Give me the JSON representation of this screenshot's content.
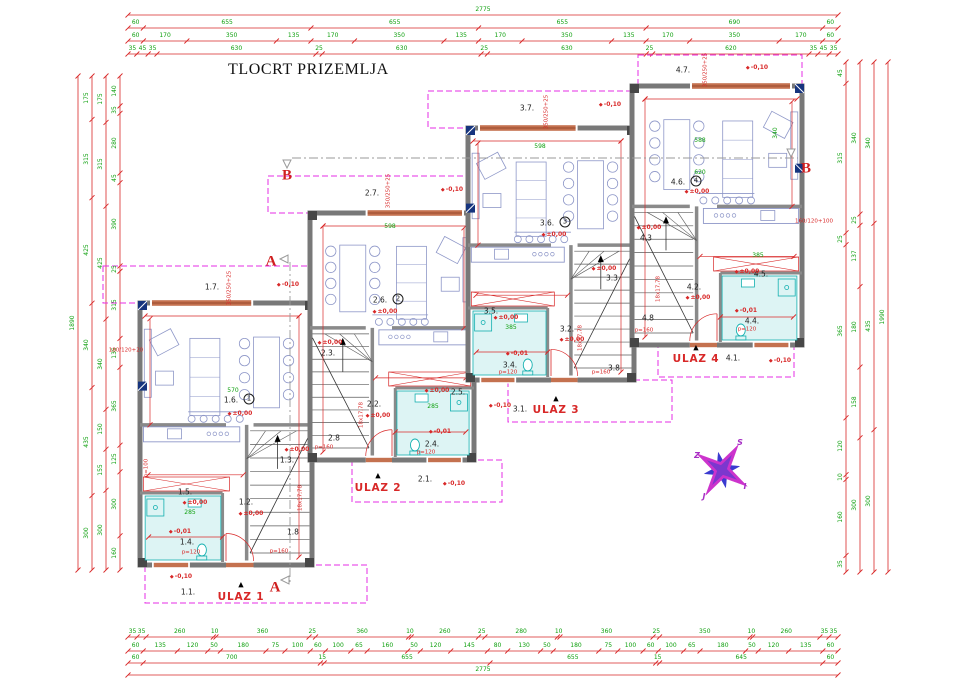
{
  "title": "TLOCRT PRIZEMLJA",
  "colors": {
    "dim_red": "#d82828",
    "dim_green": "#0fa00f",
    "wall_gray": "#787878",
    "dash_magenta": "#e52ee5",
    "furniture_blue": "#8e97c8",
    "fixture_cyan": "#14b0b0",
    "bath_fill": "#ddf4f4",
    "window_navy": "#16347e",
    "door_orange": "#c4714f",
    "compass_magenta": "#cc33cc",
    "compass_blue": "#3a3ad0"
  },
  "sections": [
    {
      "t": "B",
      "x": 287,
      "y": 176,
      "k": "section"
    },
    {
      "t": "B",
      "x": 806,
      "y": 169,
      "k": "section"
    },
    {
      "t": "A",
      "x": 271,
      "y": 262,
      "k": "section"
    },
    {
      "t": "A",
      "x": 275,
      "y": 588,
      "k": "section"
    }
  ],
  "compass_letters": [
    {
      "t": "S",
      "x": 740,
      "y": 443,
      "k": "comp"
    },
    {
      "t": "Z",
      "x": 697,
      "y": 456,
      "k": "comp"
    },
    {
      "t": "I",
      "x": 745,
      "y": 487,
      "k": "comp"
    },
    {
      "t": "J",
      "x": 704,
      "y": 497,
      "k": "comp"
    }
  ],
  "dims": {
    "top": {
      "x0": 128,
      "x1": 838,
      "rows": [
        {
          "y": 15,
          "values": [
            "2775"
          ]
        },
        {
          "y": 28,
          "values": [
            "60",
            "655",
            "655",
            "655",
            "690",
            "60"
          ]
        },
        {
          "y": 41,
          "values": [
            "60",
            "170",
            "350",
            "135",
            "170",
            "350",
            "135",
            "170",
            "350",
            "135",
            "170",
            "350",
            "170",
            "60"
          ]
        },
        {
          "y": 54,
          "values": [
            "35",
            "45",
            "35",
            "630",
            "25",
            "630",
            "25",
            "630",
            "25",
            "620",
            "35",
            "45",
            "35"
          ]
        }
      ]
    },
    "bottom": {
      "x0": 128,
      "x1": 838,
      "rows": [
        {
          "y": 637,
          "values": [
            "35",
            "35",
            "260",
            "10",
            "360",
            "25",
            "360",
            "10",
            "260",
            "25",
            "280",
            "10",
            "360",
            "25",
            "350",
            "10",
            "260",
            "35",
            "35"
          ]
        },
        {
          "y": 651,
          "values": [
            "60",
            "135",
            "120",
            "50",
            "180",
            "75",
            "100",
            "60",
            "100",
            "65",
            "160",
            "50",
            "120",
            "145",
            "80",
            "130",
            "50",
            "180",
            "75",
            "100",
            "60",
            "100",
            "65",
            "180",
            "50",
            "120",
            "135",
            "60"
          ]
        },
        {
          "y": 663,
          "values": [
            "60",
            "700",
            "15",
            "655",
            "655",
            "15",
            "645",
            "60"
          ]
        },
        {
          "y": 675,
          "values": [
            "2775"
          ]
        }
      ]
    },
    "left": {
      "y0": 76,
      "y1": 570,
      "cols": [
        {
          "x": 78,
          "values": [
            "1890"
          ]
        },
        {
          "x": 92,
          "values": [
            "175",
            "315",
            "425",
            "340",
            "435",
            "300"
          ]
        },
        {
          "x": 106,
          "values": [
            "175",
            "315",
            "425",
            "340",
            "150",
            "155",
            "300"
          ]
        },
        {
          "x": 120,
          "values": [
            "140",
            "35",
            "280",
            "45",
            "390",
            "25",
            "315",
            "135",
            "365",
            "125",
            "300",
            "160"
          ]
        }
      ]
    },
    "right": {
      "y0": 62,
      "y1": 572,
      "cols": [
        {
          "x": 846,
          "values": [
            "45",
            "315",
            "25",
            "365",
            "120",
            "10",
            "160",
            "35"
          ]
        },
        {
          "x": 860,
          "values": [
            "340",
            "25",
            "137",
            "180",
            "158",
            "300"
          ]
        },
        {
          "x": 874,
          "values": [
            "340",
            "435",
            "300"
          ]
        },
        {
          "x": 888,
          "values": [
            "1990"
          ]
        }
      ]
    }
  },
  "units": [
    {
      "id": 1,
      "entrance": "ULAZ 1",
      "labels": [
        {
          "t": "1.7.",
          "x": 212,
          "y": 287,
          "k": "room"
        },
        {
          "t": "-0,10",
          "x": 288,
          "y": 285,
          "k": "level"
        },
        {
          "t": "350/250+25",
          "x": 230,
          "y": 288,
          "k": "red",
          "r": -90
        },
        {
          "t": "570",
          "x": 233,
          "y": 391,
          "k": "green"
        },
        {
          "t": "1.6.",
          "x": 231,
          "y": 400,
          "k": "room"
        },
        {
          "t": "1",
          "x": 249,
          "y": 399,
          "k": "circ"
        },
        {
          "t": "±0,00",
          "x": 240,
          "y": 414,
          "k": "level"
        },
        {
          "t": "1.5.",
          "x": 185,
          "y": 492,
          "k": "room"
        },
        {
          "t": "±0,00",
          "x": 195,
          "y": 503,
          "k": "level"
        },
        {
          "t": "285",
          "x": 190,
          "y": 513,
          "k": "green"
        },
        {
          "t": "1.2.",
          "x": 246,
          "y": 502,
          "k": "room"
        },
        {
          "t": "±0,00",
          "x": 251,
          "y": 514,
          "k": "level"
        },
        {
          "t": "1.3.",
          "x": 287,
          "y": 460,
          "k": "room"
        },
        {
          "t": "±0,00",
          "x": 297,
          "y": 450,
          "k": "level"
        },
        {
          "t": "1.4.",
          "x": 187,
          "y": 542,
          "k": "room"
        },
        {
          "t": "-0,01",
          "x": 180,
          "y": 532,
          "k": "level"
        },
        {
          "t": "p=120",
          "x": 191,
          "y": 553,
          "k": "red"
        },
        {
          "t": "1.8",
          "x": 293,
          "y": 532,
          "k": "room"
        },
        {
          "t": "p=160",
          "x": 279,
          "y": 552,
          "k": "red"
        },
        {
          "t": "18x17,78",
          "x": 301,
          "y": 498,
          "k": "red",
          "r": -90
        },
        {
          "t": "180/120+20",
          "x": 126,
          "y": 351,
          "k": "red"
        },
        {
          "t": "1.1.",
          "x": 188,
          "y": 592,
          "k": "room"
        },
        {
          "t": "-0,10",
          "x": 181,
          "y": 577,
          "k": "level"
        },
        {
          "t": "▲",
          "x": 241,
          "y": 585,
          "k": "tri"
        },
        {
          "t": "ULAZ 1",
          "x": 241,
          "y": 597,
          "k": "ulaz"
        }
      ]
    },
    {
      "id": 2,
      "entrance": "ULAZ 2",
      "labels": [
        {
          "t": "2.7.",
          "x": 372,
          "y": 193,
          "k": "room"
        },
        {
          "t": "-0,10",
          "x": 452,
          "y": 190,
          "k": "level"
        },
        {
          "t": "350/250+25",
          "x": 389,
          "y": 191,
          "k": "red",
          "r": -90
        },
        {
          "t": "598",
          "x": 390,
          "y": 227,
          "k": "green"
        },
        {
          "t": "2.6.",
          "x": 380,
          "y": 300,
          "k": "room"
        },
        {
          "t": "2",
          "x": 398,
          "y": 299,
          "k": "circ"
        },
        {
          "t": "±0,00",
          "x": 385,
          "y": 312,
          "k": "level"
        },
        {
          "t": "2.3.",
          "x": 328,
          "y": 353,
          "k": "room"
        },
        {
          "t": "±0,00",
          "x": 330,
          "y": 343,
          "k": "level"
        },
        {
          "t": "2.2.",
          "x": 374,
          "y": 404,
          "k": "room"
        },
        {
          "t": "±0,00",
          "x": 378,
          "y": 416,
          "k": "level"
        },
        {
          "t": "2.5.",
          "x": 458,
          "y": 392,
          "k": "room"
        },
        {
          "t": "±0,00",
          "x": 437,
          "y": 391,
          "k": "level"
        },
        {
          "t": "285",
          "x": 433,
          "y": 407,
          "k": "green"
        },
        {
          "t": "2.4.",
          "x": 432,
          "y": 444,
          "k": "room"
        },
        {
          "t": "-0,01",
          "x": 440,
          "y": 432,
          "k": "level"
        },
        {
          "t": "p=120",
          "x": 426,
          "y": 453,
          "k": "red"
        },
        {
          "t": "2.8",
          "x": 334,
          "y": 438,
          "k": "room"
        },
        {
          "t": "p=160",
          "x": 324,
          "y": 448,
          "k": "red"
        },
        {
          "t": "18x17,78",
          "x": 362,
          "y": 415,
          "k": "red",
          "r": -90
        },
        {
          "t": "2.1.",
          "x": 425,
          "y": 479,
          "k": "room"
        },
        {
          "t": "-0,10",
          "x": 454,
          "y": 484,
          "k": "level"
        },
        {
          "t": "▲",
          "x": 378,
          "y": 476,
          "k": "tri"
        },
        {
          "t": "ULAZ 2",
          "x": 378,
          "y": 488,
          "k": "ulaz"
        }
      ]
    },
    {
      "id": 3,
      "entrance": "ULAZ 3",
      "labels": [
        {
          "t": "3.7.",
          "x": 527,
          "y": 108,
          "k": "room"
        },
        {
          "t": "-0,10",
          "x": 610,
          "y": 105,
          "k": "level"
        },
        {
          "t": "350/250+25",
          "x": 547,
          "y": 112,
          "k": "red",
          "r": -90
        },
        {
          "t": "598",
          "x": 540,
          "y": 147,
          "k": "green"
        },
        {
          "t": "3.6.",
          "x": 547,
          "y": 223,
          "k": "room"
        },
        {
          "t": "3",
          "x": 565,
          "y": 222,
          "k": "circ"
        },
        {
          "t": "±0,00",
          "x": 554,
          "y": 235,
          "k": "level"
        },
        {
          "t": "3.5.",
          "x": 491,
          "y": 311,
          "k": "room"
        },
        {
          "t": "±0,00",
          "x": 506,
          "y": 318,
          "k": "level"
        },
        {
          "t": "385",
          "x": 511,
          "y": 328,
          "k": "green"
        },
        {
          "t": "3.3",
          "x": 612,
          "y": 278,
          "k": "room"
        },
        {
          "t": "±0,00",
          "x": 604,
          "y": 269,
          "k": "level"
        },
        {
          "t": "3.2.",
          "x": 567,
          "y": 329,
          "k": "room"
        },
        {
          "t": "±0,00",
          "x": 572,
          "y": 340,
          "k": "level"
        },
        {
          "t": "3.4.",
          "x": 510,
          "y": 365,
          "k": "room"
        },
        {
          "t": "-0,01",
          "x": 517,
          "y": 354,
          "k": "level"
        },
        {
          "t": "p=120",
          "x": 508,
          "y": 373,
          "k": "red"
        },
        {
          "t": "3.8",
          "x": 614,
          "y": 368,
          "k": "room"
        },
        {
          "t": "p=160",
          "x": 601,
          "y": 373,
          "k": "red"
        },
        {
          "t": "18x17,78",
          "x": 581,
          "y": 338,
          "k": "red",
          "r": -90
        },
        {
          "t": "3.1.",
          "x": 520,
          "y": 409,
          "k": "room"
        },
        {
          "t": "-0,10",
          "x": 500,
          "y": 406,
          "k": "level"
        },
        {
          "t": "▲",
          "x": 556,
          "y": 399,
          "k": "tri"
        },
        {
          "t": "ULAZ 3",
          "x": 556,
          "y": 410,
          "k": "ulaz"
        }
      ]
    },
    {
      "id": 4,
      "entrance": "ULAZ 4",
      "labels": [
        {
          "t": "4.7.",
          "x": 683,
          "y": 70,
          "k": "room"
        },
        {
          "t": "-0,10",
          "x": 757,
          "y": 68,
          "k": "level"
        },
        {
          "t": "350/250+25",
          "x": 706,
          "y": 70,
          "k": "red",
          "r": -90
        },
        {
          "t": "588",
          "x": 700,
          "y": 141,
          "k": "green"
        },
        {
          "t": "4.6.",
          "x": 678,
          "y": 182,
          "k": "room"
        },
        {
          "t": "4",
          "x": 696,
          "y": 181,
          "k": "circ"
        },
        {
          "t": "±0,00",
          "x": 697,
          "y": 192,
          "k": "level"
        },
        {
          "t": "620",
          "x": 700,
          "y": 173,
          "k": "green"
        },
        {
          "t": "340",
          "x": 776,
          "y": 133,
          "k": "green",
          "r": -90
        },
        {
          "t": "4.3",
          "x": 646,
          "y": 238,
          "k": "room"
        },
        {
          "t": "±0,00",
          "x": 649,
          "y": 228,
          "k": "level"
        },
        {
          "t": "4.2.",
          "x": 694,
          "y": 287,
          "k": "room"
        },
        {
          "t": "±0,00",
          "x": 698,
          "y": 298,
          "k": "level"
        },
        {
          "t": "4.5.",
          "x": 761,
          "y": 274,
          "k": "room"
        },
        {
          "t": "±0,00",
          "x": 747,
          "y": 272,
          "k": "level"
        },
        {
          "t": "385",
          "x": 758,
          "y": 256,
          "k": "green"
        },
        {
          "t": "4.4.",
          "x": 752,
          "y": 321,
          "k": "room"
        },
        {
          "t": "-0,01",
          "x": 746,
          "y": 311,
          "k": "level"
        },
        {
          "t": "p=120",
          "x": 747,
          "y": 330,
          "k": "red"
        },
        {
          "t": "4.8",
          "x": 648,
          "y": 318,
          "k": "room"
        },
        {
          "t": "p=160",
          "x": 644,
          "y": 331,
          "k": "red"
        },
        {
          "t": "18x17,78",
          "x": 659,
          "y": 289,
          "k": "red",
          "r": -90
        },
        {
          "t": "4.1.",
          "x": 733,
          "y": 358,
          "k": "room"
        },
        {
          "t": "-0,10",
          "x": 780,
          "y": 361,
          "k": "level"
        },
        {
          "t": "▲",
          "x": 696,
          "y": 348,
          "k": "tri"
        },
        {
          "t": "ULAZ 4",
          "x": 696,
          "y": 359,
          "k": "ulaz"
        }
      ]
    }
  ],
  "extra_labels": [
    {
      "t": "160/120+100",
      "x": 814,
      "y": 222,
      "k": "red"
    },
    {
      "t": "p=100",
      "x": 147,
      "y": 468,
      "k": "red",
      "r": -90
    }
  ]
}
